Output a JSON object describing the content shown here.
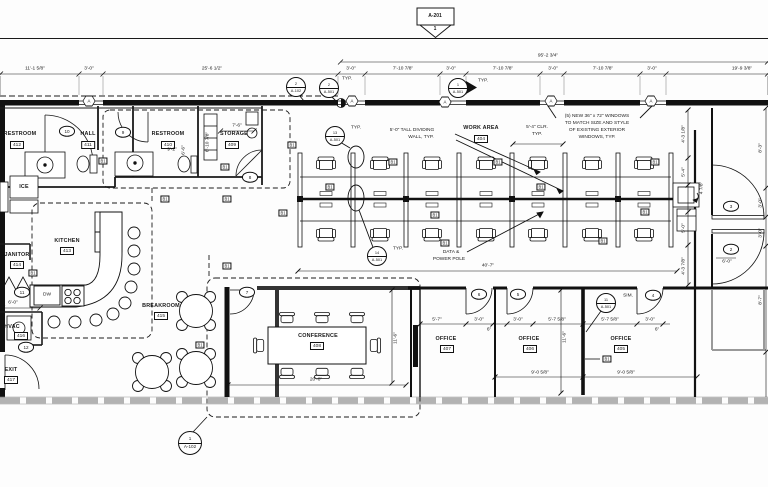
{
  "markers": {
    "top_pennant": {
      "sheet": "A-201",
      "num": "1"
    },
    "bottom_callout": {
      "num": "1",
      "sheet": "A-102"
    }
  },
  "rooms": {
    "restroom412": {
      "name": "RESTROOM",
      "num": "412"
    },
    "hall411": {
      "name": "HALL",
      "num": "411"
    },
    "restroom410": {
      "name": "RESTROOM",
      "num": "410"
    },
    "storage409": {
      "name": "STORAGE",
      "num": "409"
    },
    "kitchen413": {
      "name": "KITCHEN",
      "num": "413"
    },
    "janitor414": {
      "name": "JANITOR",
      "num": "414"
    },
    "breakroom415": {
      "name": "BREAKROOM",
      "num": "415"
    },
    "hvac416": {
      "name": "HVAC",
      "num": "416"
    },
    "exit417": {
      "name": "EXIT",
      "num": "417"
    },
    "workarea404": {
      "name": "WORK AREA",
      "num": "404"
    },
    "conference408": {
      "name": "CONFERENCE",
      "num": "408"
    },
    "office407": {
      "name": "OFFICE",
      "num": "407"
    },
    "office406": {
      "name": "OFFICE",
      "num": "406"
    },
    "office405": {
      "name": "OFFICE",
      "num": "405"
    }
  },
  "door_tags": {
    "d2": "2",
    "d3": "3",
    "d4": "4",
    "d5": "5",
    "d6": "6",
    "d7": "7",
    "d8": "8",
    "d9": "9",
    "d10": "10",
    "d11": "11",
    "d12": "12"
  },
  "wall_tag": "B1",
  "window_tag": "A",
  "callouts": {
    "c2_a102": {
      "num": "2",
      "sheet": "A-102"
    },
    "c2_a501": {
      "num": "2",
      "sheet": "A-501"
    },
    "c1_a501": {
      "num": "1",
      "sheet": "A-501"
    },
    "c13_a501": {
      "num": "13",
      "sheet": "A-501"
    },
    "c14_a501": {
      "num": "14",
      "sheet": "A-501"
    },
    "c11_a501": {
      "num": "11",
      "sheet": "A-501"
    }
  },
  "labels": {
    "typ": "TYP.",
    "sim": "SIM.",
    "ice": "ICE",
    "dw": "DW"
  },
  "notes": {
    "dividing_wall_1": "5'-0\" TALL DIVIDING",
    "dividing_wall_2": "WALL, TYP.",
    "windows_1": "(5) NEW 36\" x 72\" WINDOWS",
    "windows_2": "TO MATCH SIZE AND STYLE",
    "windows_3": "OF EXISTING EXTERIOR",
    "windows_4": "WINDOWS, TYP.",
    "clr_1": "5'-4\" CLR.",
    "clr_2": "TYP.",
    "data_pole_1": "DATA &",
    "data_pole_2": "POWER POLE"
  },
  "dims": {
    "overall": "95'-2 3/4\"",
    "t1": "11'-1 5/8\"",
    "t2": "3'-0\"",
    "t3": "25'-6 1/2\"",
    "t4": "3'-0\"",
    "t5": "7'-10 7/8\"",
    "t6": "3'-0\"",
    "t7": "7'-10 7/8\"",
    "t8": "3'-0\"",
    "t9": "7'-10 7/8\"",
    "t10": "3'-0\"",
    "t11": "19'-9 3/8\"",
    "storage_w": "7'-6\"",
    "rr_w": "9'-2\"",
    "rr_h": "6'-6\"",
    "storage_h": "6'-10 7/8\"",
    "janitor": "6'-0\"",
    "work_len": "40'-7\"",
    "conf_len": "20'-0\"",
    "conf_dep": "11'-6\"",
    "off_dep": "11'-6\"",
    "o1": "5'-7\"",
    "o2": "3'-0\"",
    "o3": "3'-0\"",
    "o4": "5'-7 5/8\"",
    "o5": "5'-7 5/8\"",
    "o6": "3'-0\"",
    "o7": "9'-0 5/8\"",
    "o8": "9'-0 5/8\"",
    "jamb": "6\"",
    "r1": "4'-3 1/8\"",
    "r2": "5'-4\"",
    "r3": "4 7/8\"",
    "r4": "5'-0\"",
    "r5": "4'-3 7/8\"",
    "e1": "8'-3\"",
    "e2": "3'-0\"",
    "e3": "3'-0\"",
    "e4": "8'-7\"",
    "door_w": "6'-0\""
  }
}
